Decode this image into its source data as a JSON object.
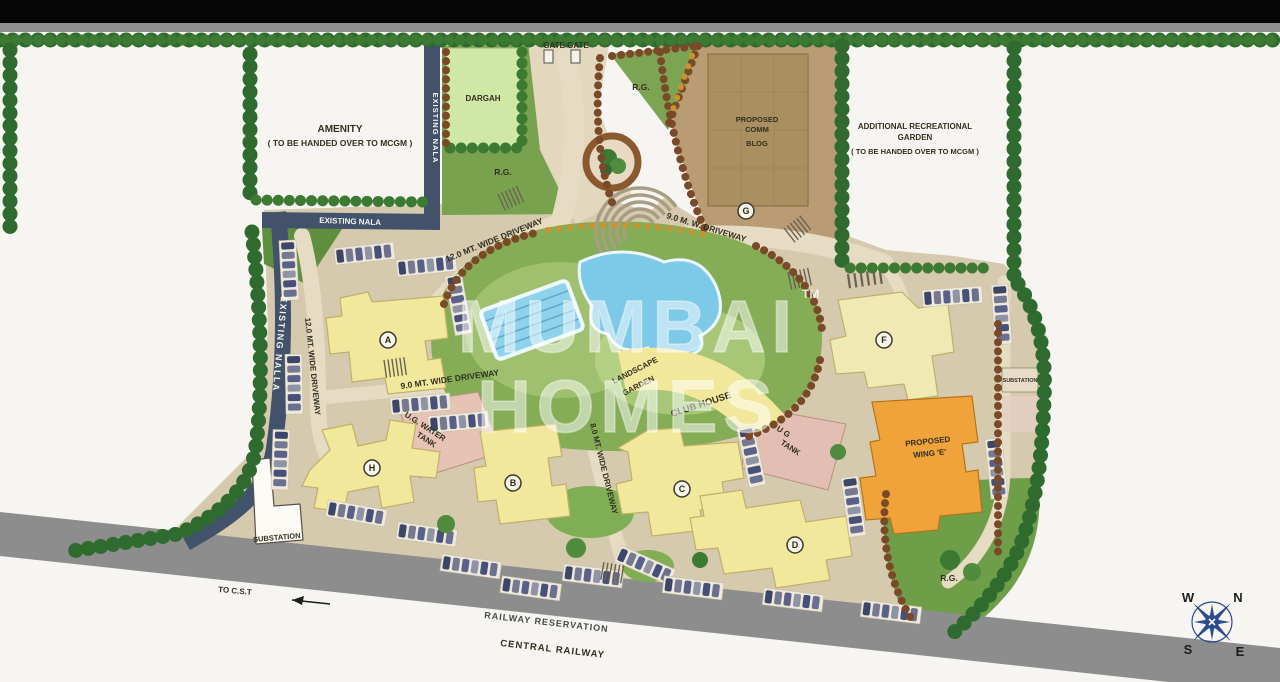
{
  "watermark": {
    "brand_line1": "MUMBAI",
    "brand_line2": "HOMES",
    "trademark": "TM"
  },
  "areas": {
    "amenity": {
      "title": "AMENITY",
      "subtitle": "( TO BE HANDED OVER TO MCGM )"
    },
    "additional_garden": {
      "line1": "ADDITIONAL RECREATIONAL",
      "line2": "GARDEN",
      "line3": "( TO BE HANDED OVER TO MCGM )"
    },
    "dargah": "DARGAH",
    "gate": "GATE GATE",
    "proposed_comm": {
      "line1": "PROPOSED",
      "line2": "COMM",
      "line3": "BLOG"
    },
    "rg_top": "R.G.",
    "rg_center": "R.G.",
    "rg_bottom": "R.G.",
    "existing_nala_top": "EXISTING NALA",
    "existing_nala_mid": "EXISTING NALA",
    "existing_nalla_left": "EXISTING NALLA",
    "landscape_garden": {
      "line1": "LANDSCAPE",
      "line2": "GARDEN"
    },
    "club_house": "CLUB HOUSE",
    "ug_water_tank": {
      "line1": "U.G. WATER",
      "line2": "TANK"
    },
    "ug_tank": {
      "line1": "U G",
      "line2": "TANK"
    },
    "wing_e": {
      "line1": "PROPOSED",
      "line2": "WING 'E'"
    },
    "substation_left": "SUBSTATION",
    "substation_right": "SUBSTATION"
  },
  "driveways": {
    "wide_12_top": "12.0 MT. WIDE DRIVEWAY",
    "wide_12_left": "12.0 MT. WIDE DRIVEWAY",
    "wide_9_mid": "9.0 MT. WIDE DRIVEWAY",
    "mw_9_top": "9.0 M. W. DRIVEWAY",
    "wide_8_mid": "8.0 MT. WIDE DRIVEWAY"
  },
  "buildings": [
    {
      "label": "A"
    },
    {
      "label": "B"
    },
    {
      "label": "C"
    },
    {
      "label": "D"
    },
    {
      "label": "F"
    },
    {
      "label": "G"
    },
    {
      "label": "H"
    }
  ],
  "railway": {
    "to_cst": "TO C.S.T",
    "reservation": "RAILWAY RESERVATION",
    "central": "CENTRAL RAILWAY"
  },
  "compass": {
    "north": "N",
    "south": "S",
    "east": "E",
    "west": "W"
  },
  "colors": {
    "campus_ground": "#d5c9ae",
    "greenery": "#7da352",
    "tree_border": "#2f6b2f",
    "water": "#7cc9e8",
    "building_yellow": "#f1e89c",
    "wing_e_orange": "#f0a33b",
    "tank_pink": "#e2bfb2",
    "nala_blue": "#42526b",
    "railway_gray": "#8d8d8d",
    "comm_brown": "#b99c74",
    "compass_blue": "#2a4b8c"
  }
}
